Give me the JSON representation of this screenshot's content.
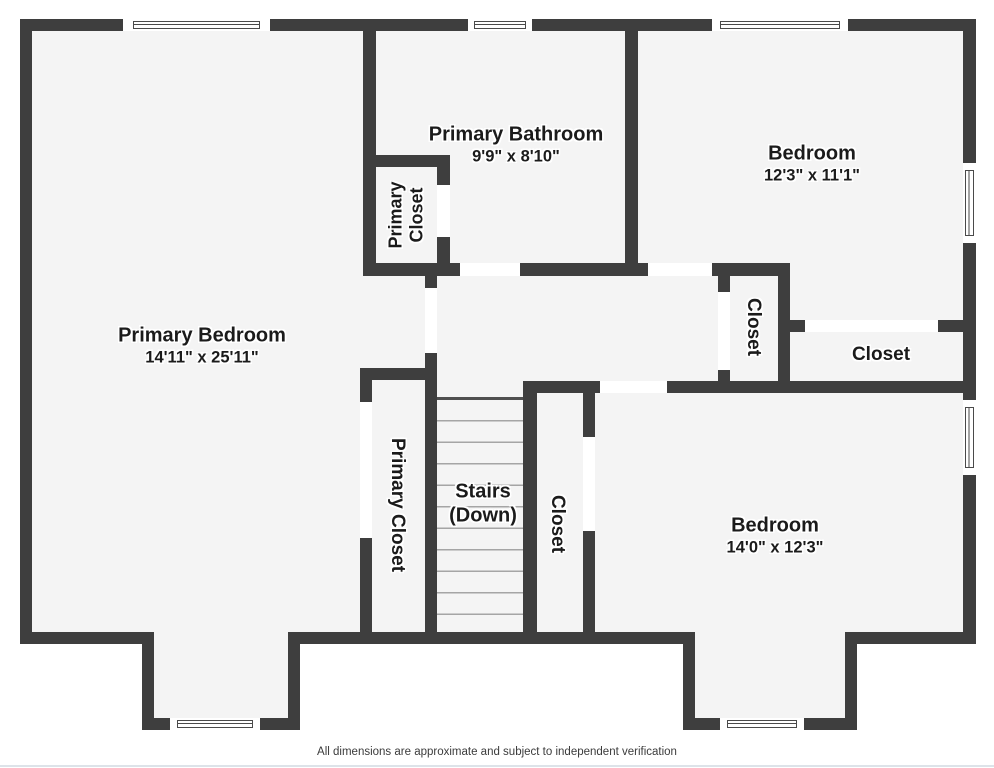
{
  "plan": {
    "rooms": {
      "primary_bedroom": {
        "name": "Primary Bedroom",
        "dims": "14'11\" x 25'11\""
      },
      "primary_bathroom": {
        "name": "Primary Bathroom",
        "dims": "9'9\" x 8'10\""
      },
      "bedroom_top": {
        "name": "Bedroom",
        "dims": "12'3\" x 11'1\""
      },
      "bedroom_bottom": {
        "name": "Bedroom",
        "dims": "14'0\" x 12'3\""
      },
      "stairs": {
        "name": "Stairs",
        "sub": "(Down)"
      },
      "primary_closet_top": {
        "line1": "Primary",
        "line2": "Closet"
      },
      "primary_closet_lower": {
        "name": "Primary Closet"
      },
      "closet_hallway": {
        "name": "Closet"
      },
      "closet_right": {
        "name": "Closet"
      },
      "closet_bedroom": {
        "name": "Closet"
      }
    },
    "footer": {
      "disclaimer": "All dimensions are approximate and subject to independent verification"
    },
    "colors": {
      "wall": "#3e3e3e",
      "floor": "#f4f4f4",
      "opening": "#ffffff",
      "bottom_rule": "#dde3e9"
    }
  }
}
